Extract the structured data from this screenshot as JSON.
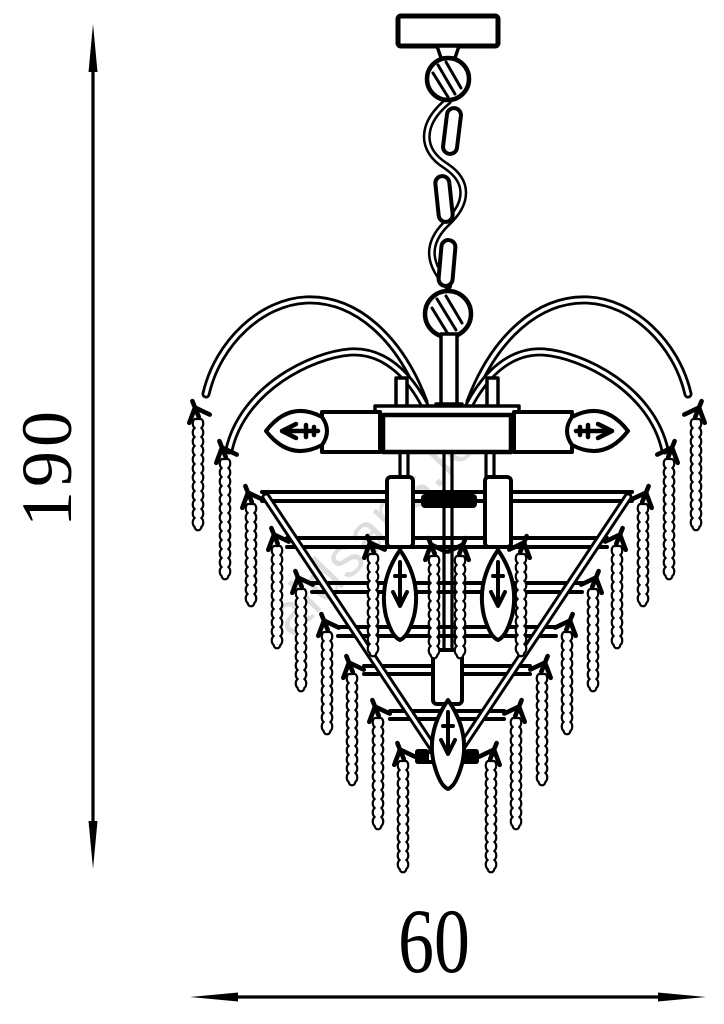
{
  "diagram": {
    "kind": "chandelier-dimension-drawing",
    "dimensions": {
      "height": {
        "value": "190"
      },
      "width": {
        "value": "60"
      }
    },
    "watermark": {
      "text": "aldsans.ie"
    },
    "colors": {
      "line": "#000000",
      "background": "#ffffff",
      "watermark": "#c2c2c2"
    }
  }
}
